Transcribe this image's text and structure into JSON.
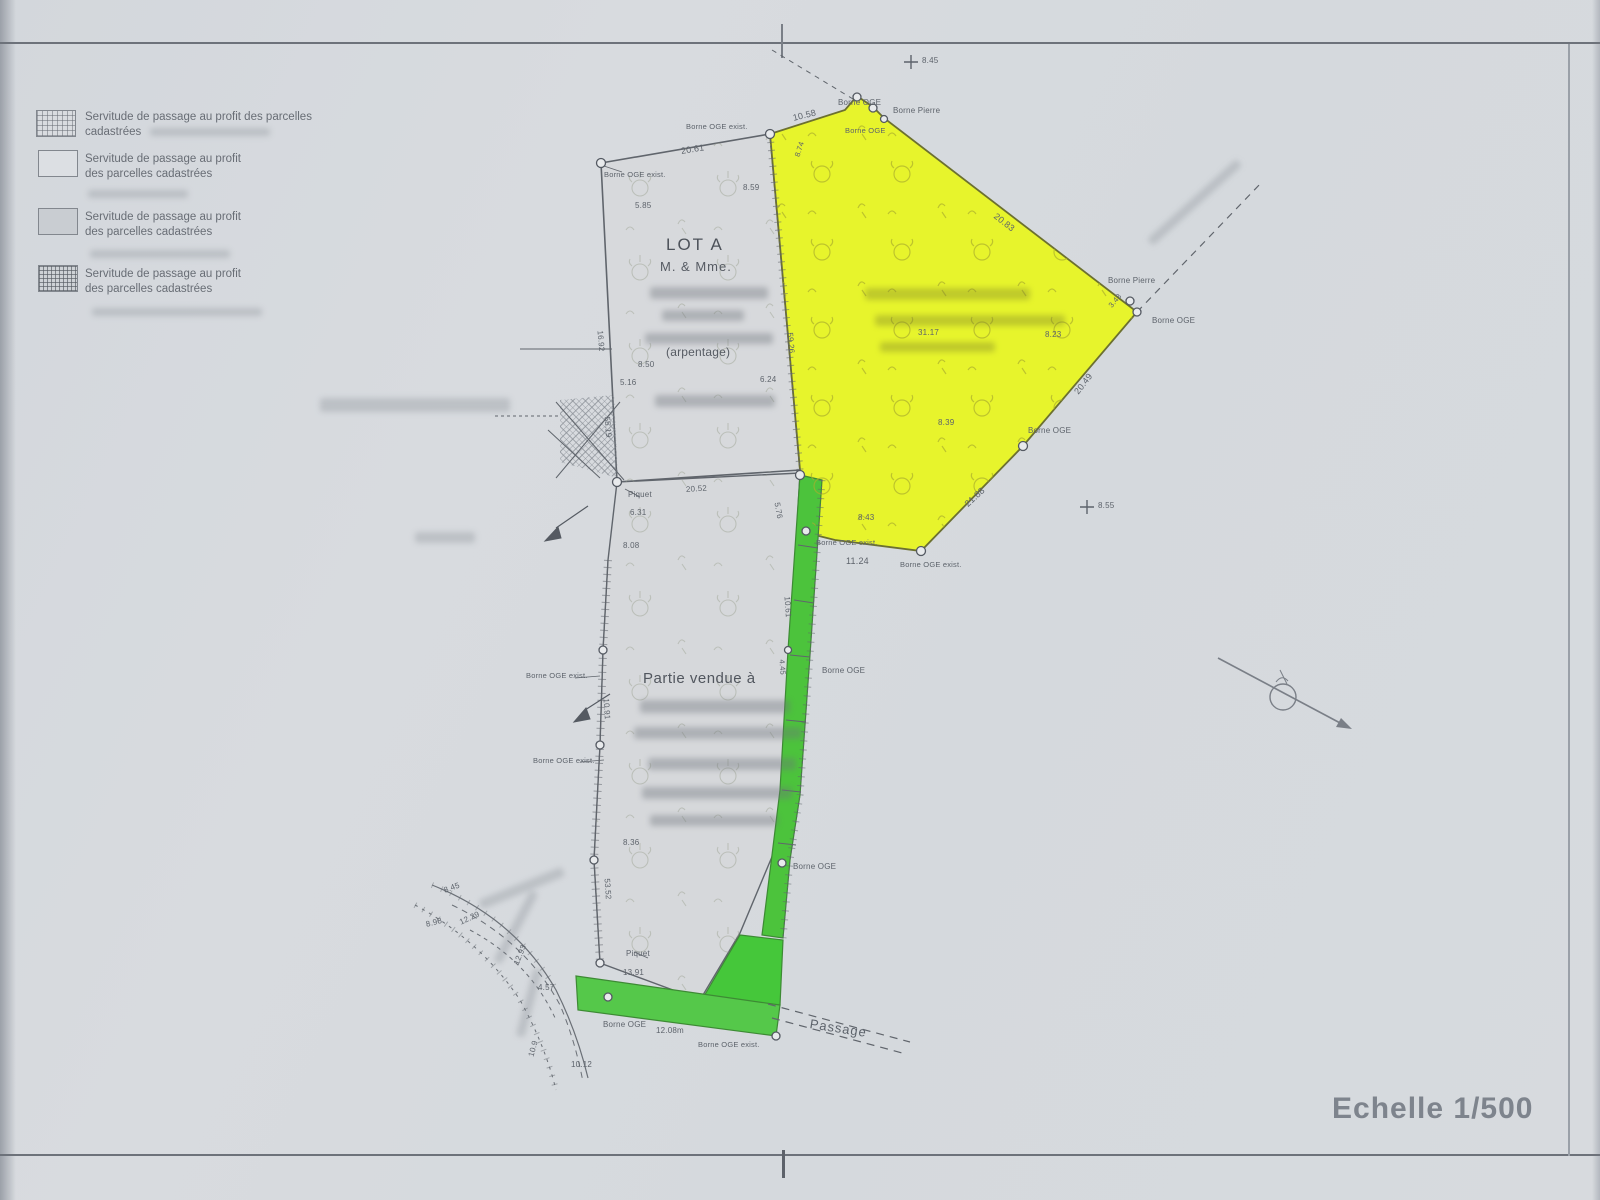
{
  "page": {
    "scale": "Echelle 1/500"
  },
  "legend": {
    "items": [
      {
        "line1": "Servitude de passage au profit des parcelles",
        "line2": "cadastrées"
      },
      {
        "line1": "Servitude de passage au profit",
        "line2": "des parcelles cadastrées"
      },
      {
        "line1": "Servitude de passage au profit",
        "line2": "des parcelles cadastrées"
      },
      {
        "line1": "Servitude de passage au profit",
        "line2": "des parcelles cadastrées"
      }
    ]
  },
  "parcels": {
    "lot_a": {
      "name": "LOT A",
      "owner": "M. & Mme.",
      "note": "(arpentage)"
    },
    "sold": {
      "caption": "Partie vendue à"
    },
    "passage": {
      "label": "Passage"
    }
  },
  "markers": {
    "borne_oge": "Borne OGE",
    "borne_pierre": "Borne Pierre",
    "borne_oge_exist": "Borne OGE exist.",
    "piquet": "Piquet"
  },
  "spot_heights": {
    "h1": "8.45",
    "h2": "8.55"
  },
  "dims": {
    "lot_a_top": "20.61",
    "lot_a_inner_a": "5.85",
    "lot_a_inner_b": "8.59",
    "lot_a_inner_c": "8.50",
    "lot_a_inner_d": "5.16",
    "lot_a_inner_e": "6.24",
    "lot_a_left_upper": "16.92",
    "lot_a_left_lower": "55.19",
    "lot_a_right": "59.26",
    "yellow_top_left": "10.58",
    "yellow_left_small": "8.74",
    "yellow_top_right": "20.83",
    "yellow_corner_small": "3.43",
    "yellow_right_lower": "20.49",
    "yellow_inner_a": "8.23",
    "yellow_inner_b": "31.17",
    "yellow_inner_c": "8.39",
    "yellow_bottom_right": "21.88",
    "yellow_bottom": "11.24",
    "yellow_bottom_small": "8.43",
    "sold_top": "20.52",
    "sold_piquet_offset": "6.31",
    "sold_left_a": "8.08",
    "sold_left_mid": "10.91",
    "sold_left_b": "8.36",
    "sold_left_lower": "53.52",
    "sold_bottom_a": "13.91",
    "strip_top_small": "5.76",
    "strip_mid": "10.61",
    "strip_seg": "4.45",
    "bottom_width": "12.08m",
    "road_a": "8.45",
    "road_b": "8.98",
    "road_c": "12.29",
    "road_d": "12.93",
    "road_e": "4.57",
    "road_f": "10.9",
    "road_g": "10.12"
  },
  "colors": {
    "yellow_parcel": "#e7f42c",
    "green_strip": "#4cc33c",
    "grey_parcel": "#d6d8db",
    "paper": "#d7dade",
    "line": "#60656c"
  }
}
